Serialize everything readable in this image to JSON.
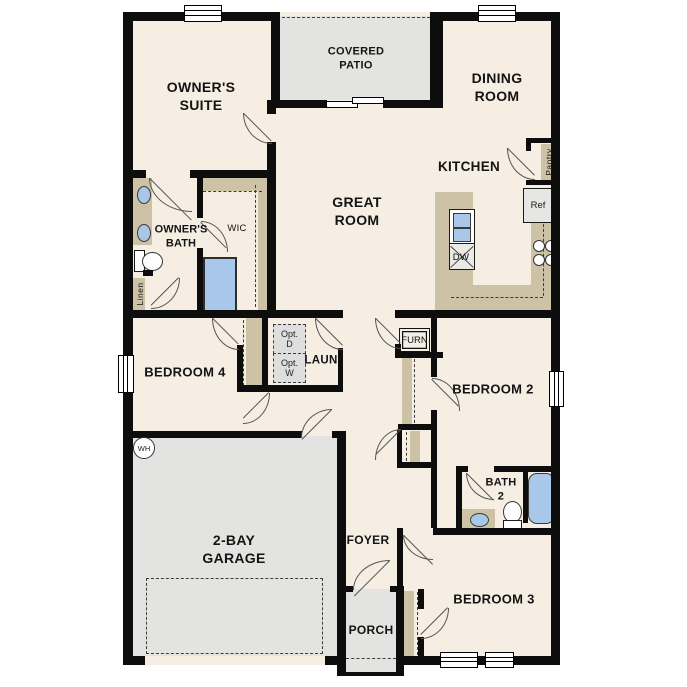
{
  "colors": {
    "wall": "#0d0d0d",
    "floor": "#f6eee2",
    "area_gray": "#e3e3e1",
    "counter_tan": "#cdc1a6",
    "fixture_blue": "#a9c8e9",
    "opt_gray": "#dedede",
    "text": "#141414",
    "door_line": "#555555"
  },
  "rooms": {
    "owners_suite": {
      "line1": "OWNER'S",
      "line2": "SUITE"
    },
    "covered_patio": {
      "line1": "COVERED",
      "line2": "PATIO"
    },
    "dining_room": {
      "line1": "DINING",
      "line2": "ROOM"
    },
    "great_room": {
      "line1": "GREAT",
      "line2": "ROOM"
    },
    "kitchen": {
      "line1": "KITCHEN"
    },
    "owners_bath": {
      "line1": "OWNER'S",
      "line2": "BATH"
    },
    "wic": {
      "line1": "WIC"
    },
    "bedroom4": {
      "line1": "BEDROOM 4"
    },
    "laundry": {
      "line1": "LAUN"
    },
    "bedroom2": {
      "line1": "BEDROOM 2"
    },
    "bath2": {
      "line1": "BATH",
      "line2": "2"
    },
    "garage": {
      "line1": "2-BAY",
      "line2": "GARAGE"
    },
    "foyer": {
      "line1": "FOYER"
    },
    "porch": {
      "line1": "PORCH"
    },
    "bedroom3": {
      "line1": "BEDROOM 3"
    }
  },
  "fixtures": {
    "pantry": "Pantry",
    "linen": "Linen",
    "refrigerator": "Ref",
    "dishwasher": "DW",
    "furnace": "FURN",
    "water_heater": "WH",
    "opt_dryer": {
      "line1": "Opt.",
      "line2": "D"
    },
    "opt_washer": {
      "line1": "Opt.",
      "line2": "W"
    }
  }
}
